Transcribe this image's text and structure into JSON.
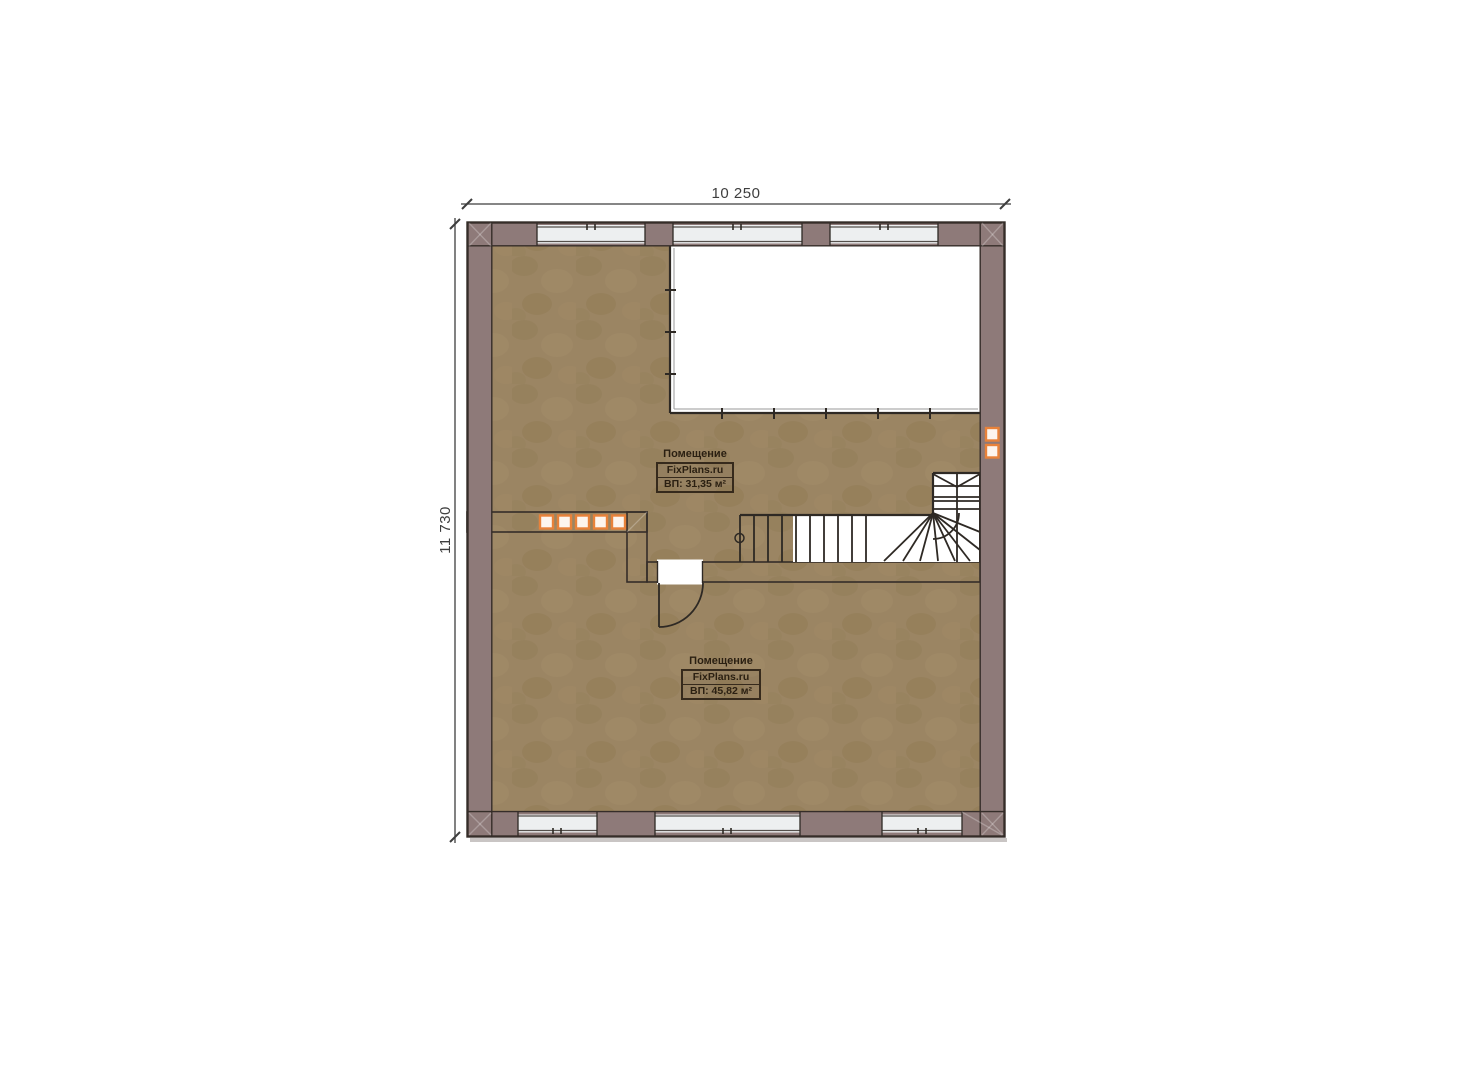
{
  "plan": {
    "dim_width": "10 250",
    "dim_height": "11 730",
    "rooms": [
      {
        "title": "Помещение",
        "brand": "FixPlans.ru",
        "area": "ВП: 31,35 м²"
      },
      {
        "title": "Помещение",
        "brand": "FixPlans.ru",
        "area": "ВП: 45,82 м²"
      }
    ],
    "colors": {
      "wall": "#8e7a79",
      "wall_outline": "#352d29",
      "line": "#2e2924",
      "floor": "#9b8563",
      "floor_dark": "#8d7852",
      "floor_light": "#a78f6c",
      "glass": "#edeff0",
      "glass_line": "#55504c",
      "marker_orange": "#e8823a",
      "marker_fill": "#fdf5ee",
      "void": "#ffffff",
      "dim": "#3e3e3e",
      "label": "#2b2012"
    }
  }
}
